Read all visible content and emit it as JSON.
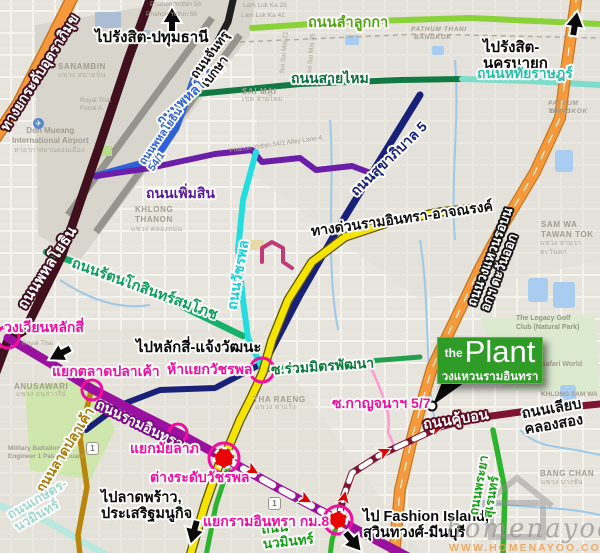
{
  "plant_sign": {
    "the": "the",
    "plant": "Plant",
    "subtitle": "วงแหวนรามอินทรา"
  },
  "direction_labels": {
    "rangsit_pathumthani": "ไปรังสิต-ปทุมธานี",
    "rangsit_nakhonnayok": "ไปรังสิต-นครนายก",
    "laksi_chaengwatthana": "ไปหลักสี่-แจ้งวัฒนะ",
    "latphrao_prasertmanukit": "ไปลาดพร้าว,\nประเสริฐมนูกิจ",
    "fashion_island": "ไป Fashion Island,\nสุวินทวงศ์-มีนบุรี"
  },
  "road_labels": {
    "uttaraphimuk_tollway": "ทางยกระดับอุตราภิมุข",
    "phahonyothin": "ถนนพหลโยธิน",
    "phahonyothin_54_1": "ถนนพหลโยธิน\n54/1",
    "chanthrubeksa": "ถนนจันทรุ\nเบกษา",
    "lam_luk_ka": "ถนนลำลูกกา",
    "sai_mai": "ถนนสายไหม",
    "hathai_rat": "ถนนหทัยราษฎร์",
    "sukhaphiban_5": "ถนนสุขาภิบาล 5",
    "phoem_sin": "ถนนเพิ่มสิน",
    "ram_inthra_expressway": "ทางด่วนรามอินทรา-อาจณรงค์",
    "watcharaphon": "ถนนวัชรพล",
    "rattanakosin_somphot": "ถนนรัตนโกสินทร์สมโภช",
    "ruam_mit_phatthana": "ซ.ร่วมมิตรพัฒนา",
    "ram_inthra": "ถนนรามอินทรา",
    "lat_pla_khao": "ถนนลาดปลาเค้า",
    "outer_ring_east": "ถนนวงแหวนรอบนอกฯ ตะวันออก",
    "khu_bon": "ถนนคู้บอน",
    "liap_khlong_song": "ถนนเลียบ\nคลองสอง",
    "phraya_suren": "ถนนพระยา\nสุเรนทร์",
    "kaset_nawamin": "ถนนเกษตร-\nนวมินทร์",
    "nawamin": "ถนน\nนวมินทร์",
    "kanchana_5_7": "ซ.กาญจนาฯ 5/7"
  },
  "junction_labels": {
    "wong_wian_lak_si": "วงเวียนหลักสี่",
    "yaek_talat_pla_khao": "แยกตลาดปลาเค้า",
    "ha_yaek_watcharaphon": "ห้าแยกวัชรพล",
    "yaek_mailap": "แยกมัยลาภ",
    "tang_radap_watcharaphon": "ต่างระดับวัชรพล",
    "yaek_ram_inthra_km8": "แยกรามอินทรา กม.8"
  },
  "area_labels": {
    "sanambin": "SANAMBIN",
    "sanambin_th": "แขวง สนามบิน",
    "don_mueang": "Don Mueang\nInternational Airport",
    "don_mueang_th": "ท่าอากาศยานดอนเมือง",
    "sai_mai_district": "SAI MAI",
    "sai_mai_th": "เขต สายไหม",
    "khlong_thanon": "KHLONG\nTHANON",
    "khlong_thanon_th": "แขวง คลองถนน",
    "anusawari": "ANUSAWARI",
    "anusawari_th": "แขวง อนุสาวรีย์",
    "tha_raeng": "THA RAENG",
    "tha_raeng_th": "แขวง ท่าแร้ง",
    "sam_wa": "SAM WA\nTAWAN TOK",
    "sam_wa_th": "แขวง สามวา\nตะวันตก",
    "bang_chan": "BANG CHAN",
    "bang_chan_th": "แขวง บางชัน",
    "legacy_golf": "The Legacy Golf\nClub (Natural Park)",
    "safari_world": "Safari World",
    "military": "Military Battalion\nEngineer 1 Palace Guard",
    "khlong_sam_wa": "KHLONG SAM WA",
    "pathum_thani": "PATHUM THANI",
    "bangkok": "BANGKOK"
  },
  "minor_street_labels": {
    "phahon_yothin_58": "Phahon Yothin 58",
    "phahon_yothin_56": "Phahon Yothin 56",
    "lam_luk_ka_29": "Lam Luk Ka 29",
    "lam_luk_ka_41": "Lam Luk Ka 41",
    "soi_sai_mai_21": "Soi Sai Mai 21",
    "soi_sai_mai_35": "Soi Sai Mai 35",
    "royal_thai_force": "Royal Thai\nForce A.",
    "royal_thai": "Royal Thai",
    "alley_54_1": "Phahon Yothin 54/1 Alley Lane 4"
  },
  "route_shield": "1",
  "watermark": {
    "brand": "homenayoo",
    "url": "WWW.HOMENAYOO.COM"
  },
  "colors": {
    "plant_sign_green": "#2e9c27",
    "junction_magenta": "#f20da0",
    "route_red": "#e10000",
    "expressway_yellow": "#f5e300",
    "ring_road_orange": "#f59a3c",
    "ram_inthra_purple": "#99119e",
    "phahonyothin_maroon": "#40101f",
    "khu_bon_dark_red": "#7e1430",
    "sukhaphiban_navy": "#18207a",
    "watcharaphon_cyan": "#22dede",
    "phoem_sin_violet": "#6b1fa8",
    "lam_luk_ka_green": "#8bd23a",
    "sai_mai_green": "#117a44",
    "hathai_rat_teal": "#7ddcca",
    "rattanakosin_green": "#15b06b",
    "nawamin_green": "#2db42d",
    "lat_pla_khao_gold": "#b8860b",
    "kaset_pale_cyan": "#b9e8e0",
    "phahonyothin_blue": "#2f62d8",
    "water_blue": "#a8cdf0"
  }
}
